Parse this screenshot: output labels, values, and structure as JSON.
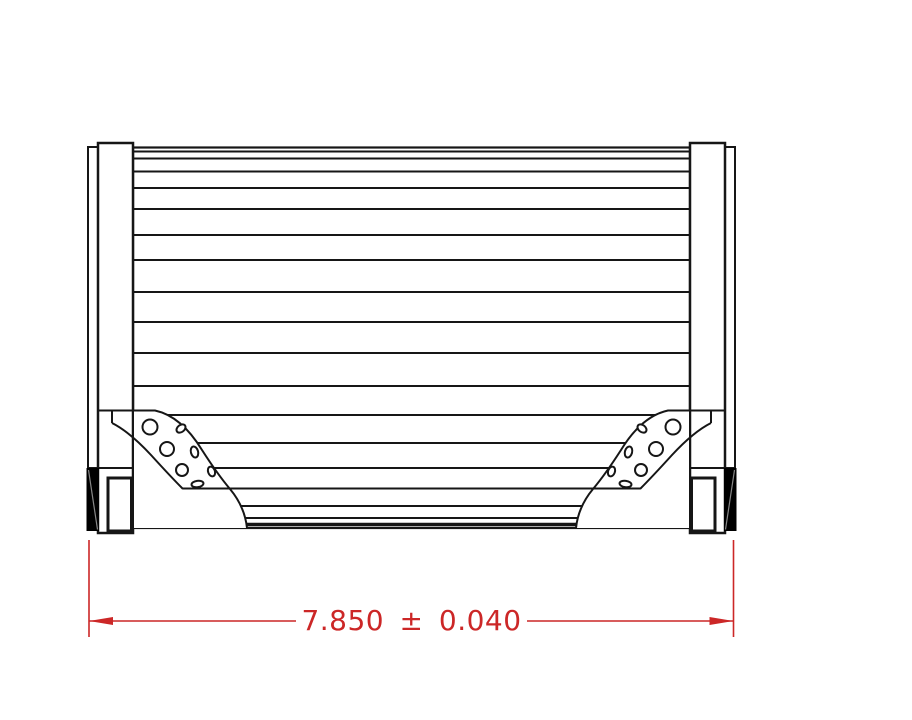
{
  "document": {
    "title": "Pleated filter element side view technical drawing"
  },
  "colors": {
    "background": "#ffffff",
    "line": "#161616",
    "fill_white": "#ffffff",
    "seal_black": "#000000",
    "seal_hatch": "#888888",
    "dimension_red": "#cc2727"
  },
  "dimension": {
    "text": "7.850 ± 0.040",
    "value": "7.850",
    "symbol": "±",
    "tolerance": "0.040"
  },
  "geometry": {
    "canvas": {
      "width": 912,
      "height": 720
    },
    "mirror_axis_x": 411.5,
    "body": {
      "x1": 133,
      "y1": 147.5,
      "x2": 690,
      "y2": 528,
      "stroke": 2.2
    },
    "pleat_lines": [
      {
        "y": 151.5,
        "x1": 134,
        "x2": 689,
        "w": 2
      },
      {
        "y": 158.5,
        "x1": 134,
        "x2": 689,
        "w": 2
      },
      {
        "y": 171.5,
        "x1": 134,
        "x2": 689,
        "w": 2
      },
      {
        "y": 188,
        "x1": 134,
        "x2": 689,
        "w": 2
      },
      {
        "y": 209,
        "x1": 134,
        "x2": 689,
        "w": 2
      },
      {
        "y": 235,
        "x1": 134,
        "x2": 689,
        "w": 2
      },
      {
        "y": 260,
        "x1": 134,
        "x2": 689,
        "w": 2
      },
      {
        "y": 292,
        "x1": 134,
        "x2": 689,
        "w": 2
      },
      {
        "y": 322,
        "x1": 134,
        "x2": 689,
        "w": 2
      },
      {
        "y": 353,
        "x1": 134,
        "x2": 689,
        "w": 2
      },
      {
        "y": 386,
        "x1": 134,
        "x2": 689,
        "w": 2
      },
      {
        "y": 415,
        "x1": 150,
        "x2": 673,
        "w": 2
      },
      {
        "y": 443,
        "x1": 190,
        "x2": 633,
        "w": 2
      },
      {
        "y": 468,
        "x1": 205,
        "x2": 618,
        "w": 2
      },
      {
        "y": 488.5,
        "x1": 225,
        "x2": 598,
        "w": 2
      },
      {
        "y": 506,
        "x1": 235,
        "x2": 588,
        "w": 2
      },
      {
        "y": 518,
        "x1": 238,
        "x2": 585,
        "w": 2
      }
    ],
    "thick_bottom_line": {
      "y": 524.5,
      "x1": 240,
      "x2": 583,
      "w": 3.5
    },
    "cone_holes": {
      "circles": [
        {
          "cx": 150,
          "cy": 427,
          "r": 7.5
        },
        {
          "cx": 167,
          "cy": 449,
          "r": 7
        },
        {
          "cx": 182,
          "cy": 470,
          "r": 6
        }
      ],
      "ellipses": [
        {
          "cx": 181,
          "cy": 428.5,
          "rx": 5,
          "ry": 3.5,
          "rot": -38
        },
        {
          "cx": 194.5,
          "cy": 452,
          "rx": 3.6,
          "ry": 5.6,
          "rot": -15
        },
        {
          "cx": 211.5,
          "cy": 471.5,
          "rx": 3.4,
          "ry": 5,
          "rot": -20
        },
        {
          "cx": 197.5,
          "cy": 484,
          "rx": 6,
          "ry": 3.2,
          "rot": -8
        }
      ],
      "stroke_w": 2
    },
    "dimension_annotation": {
      "ext_left_x": 89,
      "ext_right_x": 733.5,
      "ext_y1": 540,
      "ext_y2": 637,
      "line_y": 621,
      "left_seg_x2": 296,
      "right_seg_x1": 527,
      "text_x": 411.5,
      "text_y": 630,
      "arrow_len": 24,
      "arrow_half_h": 4
    }
  }
}
